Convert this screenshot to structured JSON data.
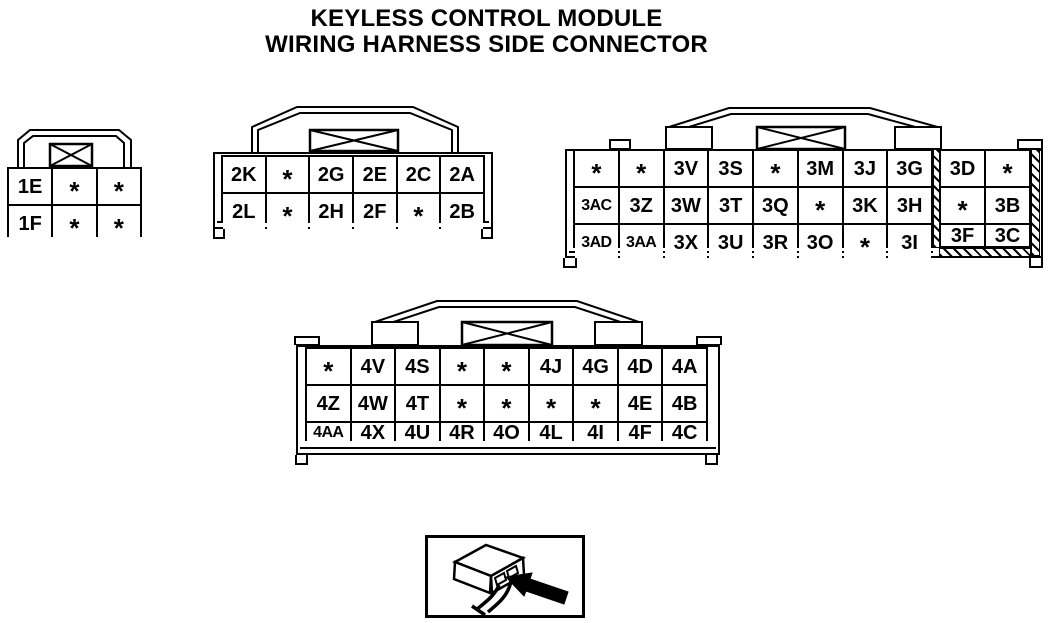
{
  "title": {
    "line1": "KEYLESS CONTROL MODULE",
    "line2": "WIRING HARNESS SIDE CONNECTOR"
  },
  "colors": {
    "line": "#000000",
    "background": "#ffffff"
  },
  "unused_pin_symbol": "*",
  "connectors": {
    "c1": {
      "pin_rows": [
        [
          "1E",
          "*",
          "*"
        ],
        [
          "1F",
          "*",
          "*"
        ]
      ]
    },
    "c2": {
      "pin_rows": [
        [
          "2K",
          "*",
          "2G",
          "2E",
          "2C",
          "2A"
        ],
        [
          "2L",
          "*",
          "2H",
          "2F",
          "*",
          "2B"
        ]
      ]
    },
    "c3": {
      "pin_rows": [
        [
          "*",
          "*",
          "3V",
          "3S",
          "*",
          "3M",
          "3J",
          "3G"
        ],
        [
          "3AC",
          "3Z",
          "3W",
          "3T",
          "3Q",
          "*",
          "3K",
          "3H"
        ],
        [
          "3AD",
          "3AA",
          "3X",
          "3U",
          "3R",
          "3O",
          "*",
          "3I"
        ]
      ],
      "sub_pin_rows": [
        [
          "3D",
          "*"
        ],
        [
          "*",
          "3B"
        ],
        [
          "3F",
          "3C"
        ]
      ]
    },
    "c4": {
      "pin_rows": [
        [
          "*",
          "4V",
          "4S",
          "*",
          "*",
          "4J",
          "4G",
          "4D",
          "4A"
        ],
        [
          "4Z",
          "4W",
          "4T",
          "*",
          "*",
          "*",
          "*",
          "4E",
          "4B"
        ],
        [
          "4AA",
          "4X",
          "4U",
          "4R",
          "4O",
          "4L",
          "4I",
          "4F",
          "4C"
        ]
      ]
    }
  },
  "legend": {
    "icon": "connector-rear-view-icon"
  }
}
